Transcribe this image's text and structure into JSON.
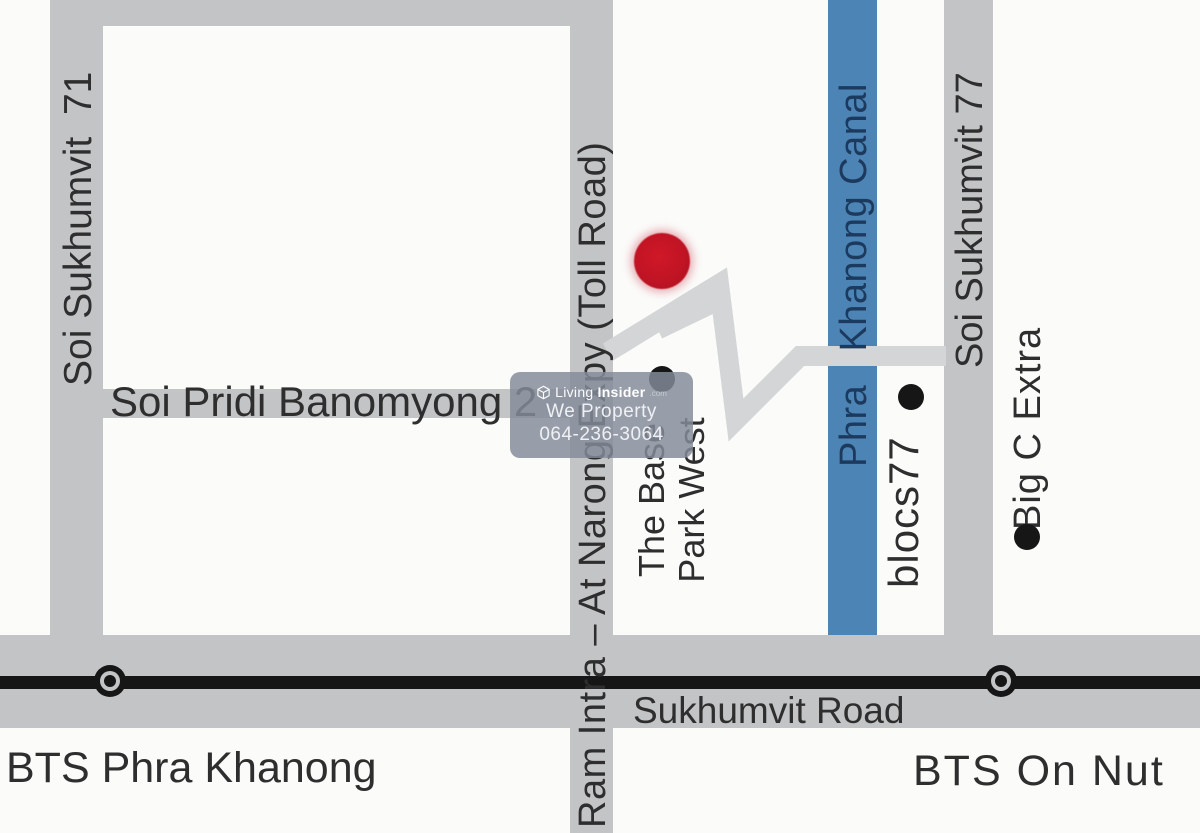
{
  "colors": {
    "road_gray": "#c3c4c6",
    "connector_gray": "#d4d5d7",
    "canal_blue": "#4d84b6",
    "canal_text_navy": "#1c3a5e",
    "label_black": "#2e2e2e",
    "bts_black": "#161616",
    "marker_red": "#c01424",
    "watermark_gray": "rgba(132,139,152,0.84)"
  },
  "roads": {
    "soi_71": "Soi Sukhumvit  71",
    "toll_road": "Ram Intra – At Narong Expy (Toll Road)",
    "pridi": "Soi Pridi Banomyong 2",
    "soi_77": "Soi Sukhumvit 77",
    "sukhumvit": "Sukhumvit Road"
  },
  "canal": {
    "label": "Phra   Khanong Canal"
  },
  "pois": {
    "the_base_line1": "The Base",
    "the_base_line2": "Park West",
    "blocs77": "blocs77",
    "big_c": "Big C Extra"
  },
  "bts": {
    "phra_khanong": "BTS Phra Khanong",
    "on_nut": "BTS On Nut"
  },
  "watermark": {
    "brand_light": "Living",
    "brand_bold": "Insider",
    "brand_suffix": ".com",
    "line2": "We Property",
    "line3": "064-236-3064"
  }
}
